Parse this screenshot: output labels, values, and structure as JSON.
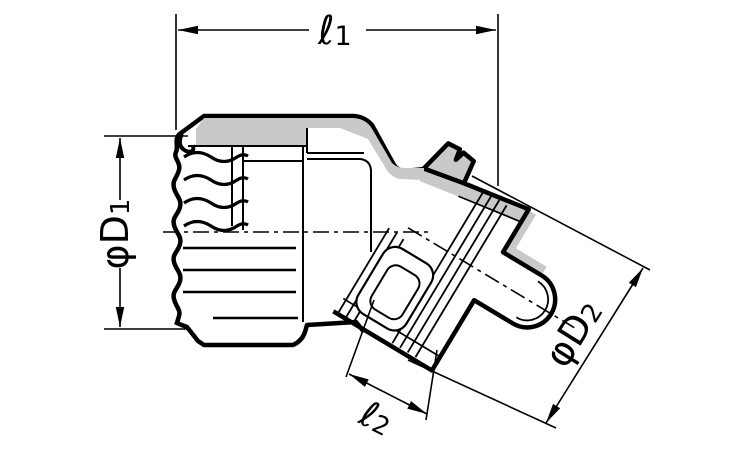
{
  "drawing": {
    "kind": "dimensioned cross-section line drawing of a 45-degree conduit connector fitting",
    "colors": {
      "line": "#000000",
      "section_fill": "#c9c9c9",
      "background": "#ffffff"
    }
  },
  "dims": {
    "l1": {
      "text": "ℓ1",
      "main": "ℓ",
      "sub": "1"
    },
    "d1": {
      "text": "φD1",
      "main": "φD",
      "sub": "1"
    },
    "d2": {
      "text": "φD2",
      "main": "φD",
      "sub": "2"
    },
    "l2": {
      "text": "ℓ2",
      "main": "ℓ",
      "sub": "2"
    }
  }
}
